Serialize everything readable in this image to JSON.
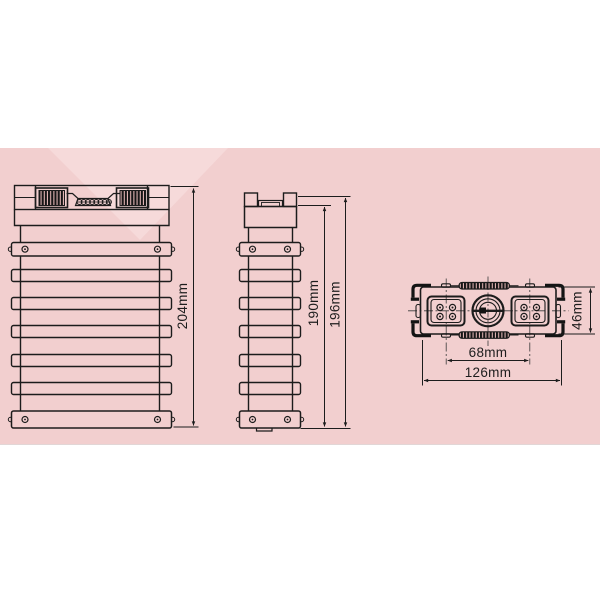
{
  "colors": {
    "background": "#ffffff",
    "panel": "#f2cfcf",
    "watermark": "#f6dada",
    "line": "#1c1c1c",
    "label": "#1d1d1d"
  },
  "drawing": {
    "type": "battery-cell-three-view-dimension-drawing",
    "front_view": {
      "name": "front view",
      "height": {
        "label": "204mm"
      }
    },
    "side_view": {
      "name": "side view",
      "body_height": {
        "label": "190mm"
      },
      "overall_height": {
        "label": "196mm"
      }
    },
    "top_view": {
      "name": "top view",
      "terminal_pitch": {
        "label": "68mm"
      },
      "overall_width": {
        "label": "126mm"
      },
      "overall_depth": {
        "label": "46mm"
      }
    }
  }
}
